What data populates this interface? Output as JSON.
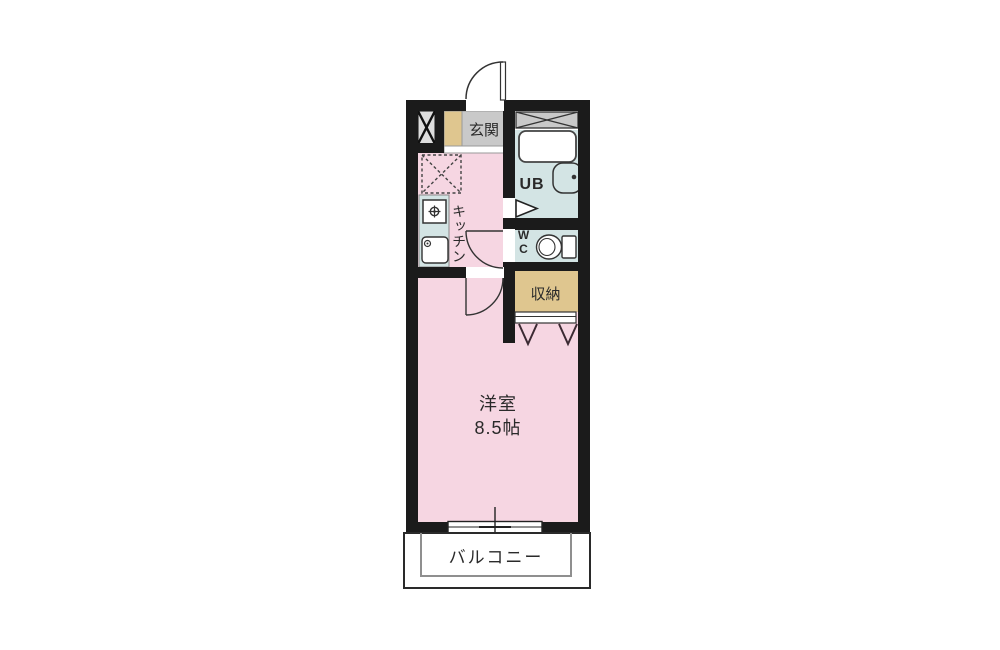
{
  "floorplan": {
    "entrance": {
      "label": "玄関"
    },
    "unit_bath": {
      "label": "UB"
    },
    "toilet": {
      "label_line1": "W",
      "label_line2": "C"
    },
    "kitchen": {
      "label": "キッチン"
    },
    "storage": {
      "label": "収納"
    },
    "main_room": {
      "name": "洋室",
      "size": "8.5帖"
    },
    "balcony": {
      "label": "バルコニー"
    },
    "colors": {
      "wall": "#1b1b1b",
      "room_pink": "#f6d6e2",
      "wet_area_blue": "#d3e4e4",
      "storage_tan": "#dfc68f",
      "entry_gray": "#c9c9c9",
      "outline": "#333333"
    }
  }
}
